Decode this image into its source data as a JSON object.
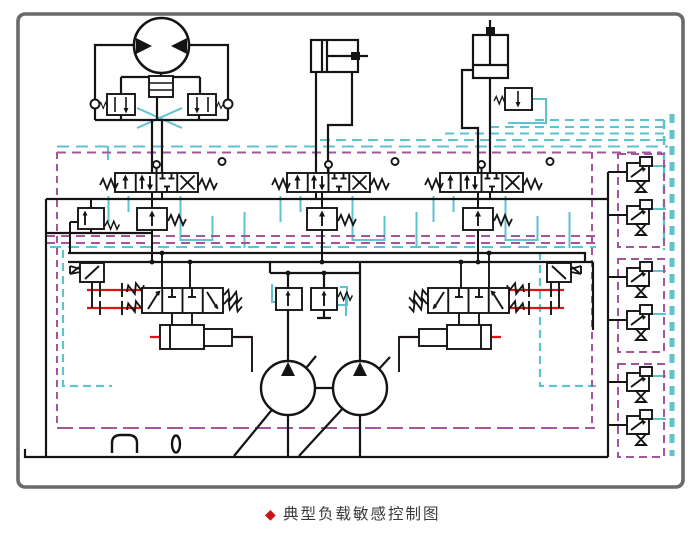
{
  "figure": {
    "caption_marker": "◆",
    "caption": "典型负载敏感控制图"
  },
  "palette": {
    "line": "#141414",
    "ls_signal_cyan": "#5fc2cf",
    "boundary_magenta": "#a4559e",
    "feedback_red": "#dd1512",
    "outer_frame_gray": "#6a6a6a",
    "caption_text": "#3b3b3b",
    "caption_marker_red": "#c8131b"
  },
  "components": {
    "motor": "hydraulic-motor",
    "cyl_h": "horizontal-cylinder",
    "cyl_v": "vertical-cylinder",
    "dir_valve": "directional-spool-valve",
    "compensator": "pressure-compensator-valve",
    "inlet_comp": "inlet-compensator-valve",
    "regulator": "pump-regulator-valve-group",
    "pump": "variable-displacement-pump",
    "pilot_col": "pilot-valve-column",
    "tank_breather": "tank-breather",
    "tank_plug": "tank-plug"
  }
}
